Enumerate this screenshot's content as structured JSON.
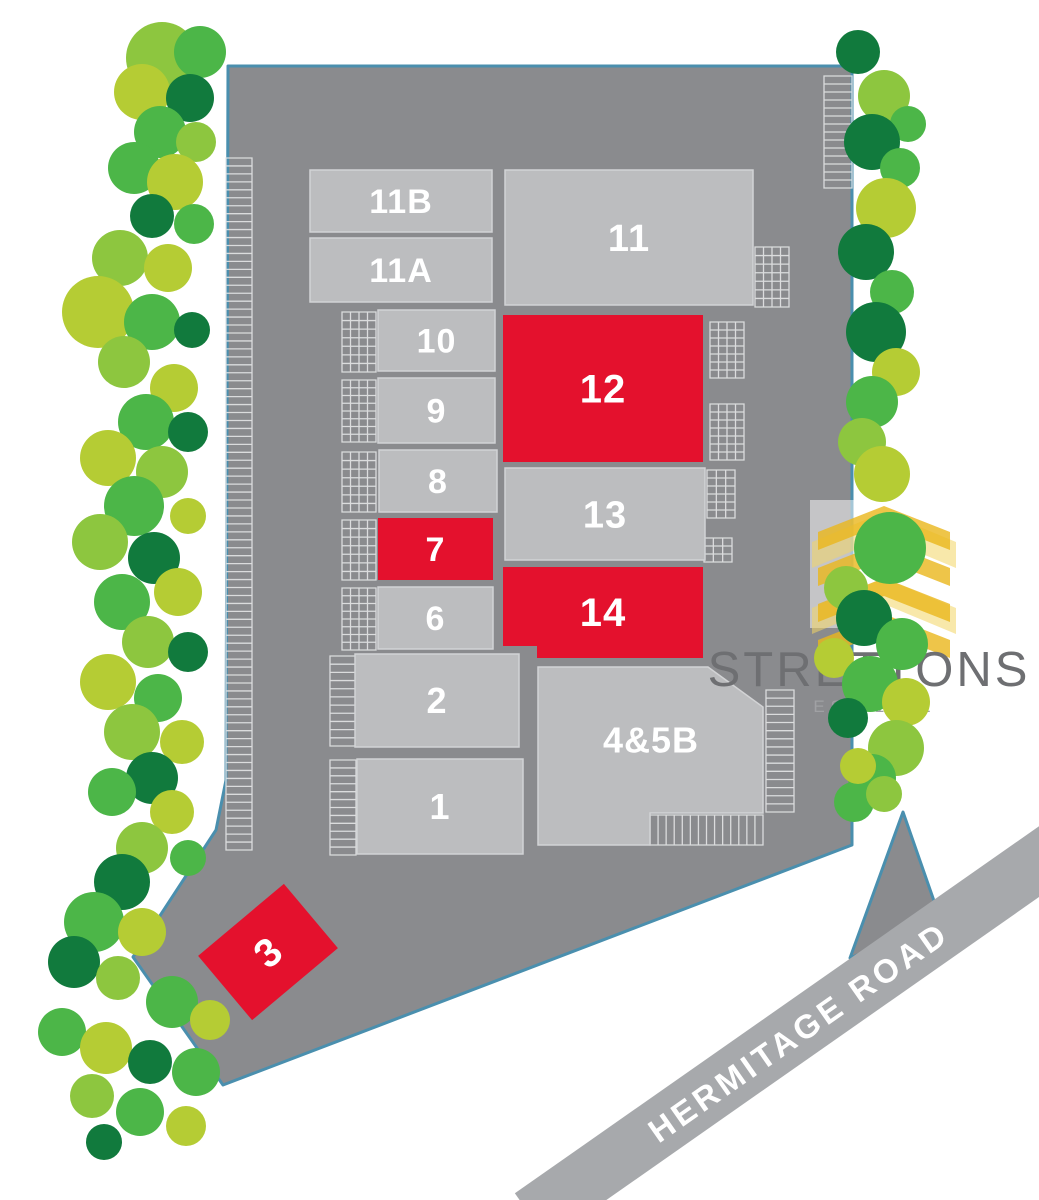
{
  "plan": {
    "units": [
      {
        "id": "11B",
        "label": "11B",
        "status": "standard"
      },
      {
        "id": "11A",
        "label": "11A",
        "status": "standard"
      },
      {
        "id": "10",
        "label": "10",
        "status": "standard"
      },
      {
        "id": "9",
        "label": "9",
        "status": "standard"
      },
      {
        "id": "8",
        "label": "8",
        "status": "standard"
      },
      {
        "id": "7",
        "label": "7",
        "status": "highlighted"
      },
      {
        "id": "6",
        "label": "6",
        "status": "standard"
      },
      {
        "id": "2",
        "label": "2",
        "status": "standard"
      },
      {
        "id": "1",
        "label": "1",
        "status": "standard"
      },
      {
        "id": "11",
        "label": "11",
        "status": "standard"
      },
      {
        "id": "12",
        "label": "12",
        "status": "highlighted"
      },
      {
        "id": "13",
        "label": "13",
        "status": "standard"
      },
      {
        "id": "14",
        "label": "14",
        "status": "highlighted"
      },
      {
        "id": "4and5B",
        "label": "4&5B",
        "status": "standard"
      },
      {
        "id": "3",
        "label": "3",
        "status": "highlighted"
      }
    ],
    "road": {
      "label": "HERMITAGE ROAD"
    },
    "logo": {
      "name": "STRETTONS",
      "tagline": "EST 1931"
    },
    "colors": {
      "site_gray": "#8a8b8e",
      "building_gray": "#bcbdbf",
      "highlight_red": "#e4112d",
      "boundary_blue": "#4a8fae",
      "road_gray": "#a7a9ac",
      "parking_line": "#e3e4e5",
      "label_white": "#ffffff",
      "logo_gold": "#eab71c",
      "logo_text_gray": "#6e6f72",
      "est_text_gray": "#a0a1a4",
      "tree_greens": [
        "#b5cc34",
        "#4cb648",
        "#117a3d",
        "#8dc63f",
        "#0c6b34"
      ]
    }
  }
}
